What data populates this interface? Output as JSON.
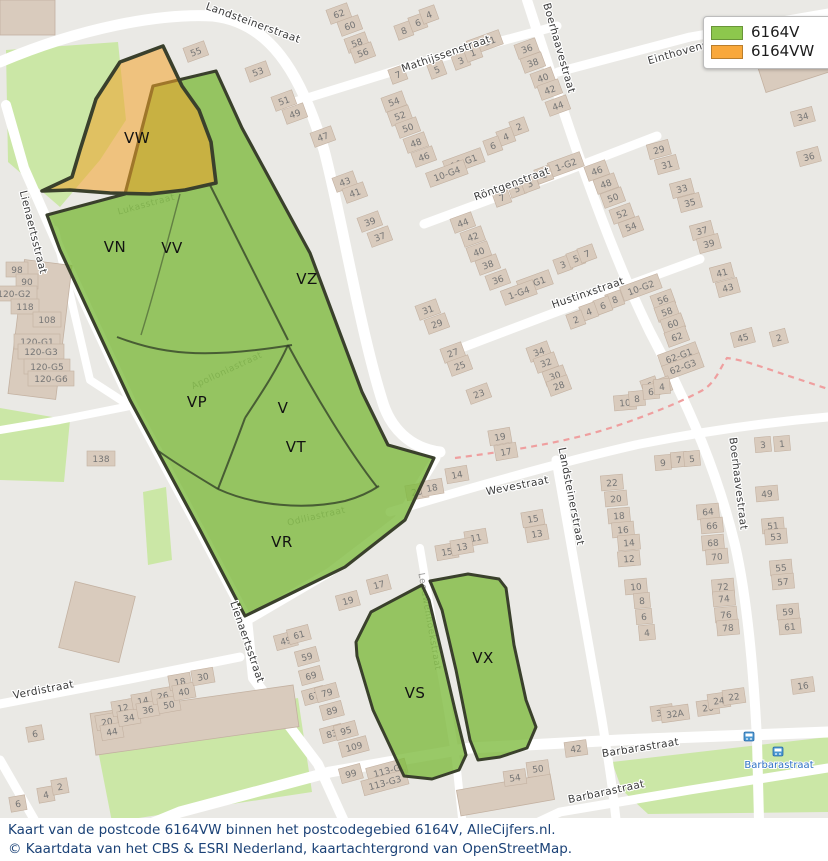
{
  "legend": {
    "items": [
      {
        "label": "6164V",
        "color": "#8dc74d"
      },
      {
        "label": "6164VW",
        "color": "#f9a83b"
      }
    ]
  },
  "caption": {
    "line1": "Kaart van de postcode 6164VW binnen het postcodegebied 6164V, AlleCijfers.nl.",
    "line2": "© Kaartdata van het CBS & ESRI Nederland, kaartachtergrond van OpenStreetMap."
  },
  "colors": {
    "area_green_fill": "rgba(124,186,60,0.78)",
    "area_orange_fill": "rgba(242,163,42,0.55)",
    "area_border": "#3a402c",
    "park": "#cbe7a6",
    "block": "#eae9e5",
    "building": "#d9cbbd",
    "boundary_dash": "#ef9f9f",
    "bus_blue": "#2f72c4"
  },
  "regions": [
    {
      "label": "VW",
      "x": 137,
      "y": 143
    },
    {
      "label": "VN",
      "x": 115,
      "y": 252
    },
    {
      "label": "VV",
      "x": 172,
      "y": 253
    },
    {
      "label": "VZ",
      "x": 307,
      "y": 284
    },
    {
      "label": "VP",
      "x": 197,
      "y": 407
    },
    {
      "label": "V",
      "x": 283,
      "y": 413
    },
    {
      "label": "VT",
      "x": 296,
      "y": 452
    },
    {
      "label": "VR",
      "x": 282,
      "y": 547
    },
    {
      "label": "VS",
      "x": 415,
      "y": 698
    },
    {
      "label": "VX",
      "x": 483,
      "y": 663
    }
  ],
  "street_labels": [
    [
      "Landsteinerstraat",
      252,
      26,
      20,
      "s"
    ],
    [
      "Mathijssenstraat",
      447,
      57,
      -19,
      "s"
    ],
    [
      "Boerhaavestraat",
      556,
      49,
      74,
      "s"
    ],
    [
      "Einthovenstraat",
      692,
      52,
      -16,
      "s"
    ],
    [
      "Röntgenstraat",
      513,
      187,
      -20,
      "s"
    ],
    [
      "Hustinxstraat",
      589,
      296,
      -19,
      "s"
    ],
    [
      "Wevestraat",
      518,
      489,
      -11,
      "s"
    ],
    [
      "Landsteinerstraat",
      568,
      497,
      79,
      "s"
    ],
    [
      "Boerhaavestraat",
      735,
      484,
      83,
      "s"
    ],
    [
      "Lienaertsstraat",
      30,
      233,
      76,
      "s"
    ],
    [
      "Lienaertsstraat",
      244,
      643,
      71,
      "s"
    ],
    [
      "Verdistraat",
      44,
      693,
      -11,
      "s"
    ],
    [
      "Barbarastraat",
      641,
      751,
      -9,
      "s"
    ],
    [
      "Barbarastraat",
      607,
      795,
      -12,
      "s"
    ],
    [
      "Apolloniastraat",
      228,
      373,
      -25,
      "f"
    ],
    [
      "Odiliastraat",
      317,
      519,
      -13,
      "f"
    ],
    [
      "Lukasstraat",
      147,
      207,
      -15,
      "f"
    ],
    [
      "Leeuwenhoekstraat",
      427,
      622,
      80,
      "f"
    ]
  ],
  "bus_stop": {
    "label": "Barbarastraat"
  },
  "building_numbers": [
    [
      "55",
      196,
      52,
      -20
    ],
    [
      "53",
      258,
      72,
      -20
    ],
    [
      "51",
      284,
      101,
      -20
    ],
    [
      "49",
      295,
      114,
      -20
    ],
    [
      "62",
      339,
      14,
      -20
    ],
    [
      "60",
      350,
      26,
      -20
    ],
    [
      "58",
      357,
      43,
      -20
    ],
    [
      "56",
      363,
      53,
      -20
    ],
    [
      "8",
      404,
      31,
      -20
    ],
    [
      "6",
      418,
      23,
      -20
    ],
    [
      "4",
      429,
      15,
      -20
    ],
    [
      "7",
      398,
      75,
      -20
    ],
    [
      "5",
      437,
      70,
      -20
    ],
    [
      "3",
      461,
      61,
      -20
    ],
    [
      "1-G1",
      485,
      43,
      -20
    ],
    [
      "1",
      473,
      53,
      -20
    ],
    [
      "54",
      394,
      102,
      -20
    ],
    [
      "52",
      400,
      116,
      -20
    ],
    [
      "50",
      408,
      128,
      -20
    ],
    [
      "48",
      416,
      143,
      -20
    ],
    [
      "47",
      323,
      137,
      -20
    ],
    [
      "36",
      527,
      49,
      -20
    ],
    [
      "38",
      533,
      63,
      -20
    ],
    [
      "40",
      543,
      78,
      -20
    ],
    [
      "42",
      550,
      90,
      -20
    ],
    [
      "44",
      558,
      106,
      -20
    ],
    [
      "2",
      519,
      127,
      -20
    ],
    [
      "4",
      506,
      137,
      -20
    ],
    [
      "6",
      493,
      146,
      -20
    ],
    [
      "46",
      424,
      157,
      -20
    ],
    [
      "10-G1",
      464,
      162,
      -20
    ],
    [
      "10-G4",
      447,
      174,
      -20
    ],
    [
      "1-G2",
      566,
      165,
      -20
    ],
    [
      "46",
      597,
      171,
      -20
    ],
    [
      "48",
      606,
      184,
      -20
    ],
    [
      "50",
      613,
      198,
      -20
    ],
    [
      "52",
      622,
      214,
      -20
    ],
    [
      "54",
      631,
      227,
      -20
    ],
    [
      "7",
      502,
      198,
      -20
    ],
    [
      "5",
      517,
      189,
      -20
    ],
    [
      "3",
      530,
      184,
      -20
    ],
    [
      "1",
      544,
      175,
      -20
    ],
    [
      "44",
      463,
      223,
      -20
    ],
    [
      "42",
      473,
      237,
      -20
    ],
    [
      "40",
      479,
      252,
      -20
    ],
    [
      "38",
      488,
      265,
      -20
    ],
    [
      "36",
      498,
      280,
      -20
    ],
    [
      "1-G1",
      535,
      283,
      -20
    ],
    [
      "1-G4",
      519,
      293,
      -20
    ],
    [
      "3",
      563,
      265,
      -20
    ],
    [
      "5",
      576,
      259,
      -20
    ],
    [
      "7",
      587,
      254,
      -20
    ],
    [
      "29",
      659,
      150,
      -15
    ],
    [
      "31",
      667,
      165,
      -15
    ],
    [
      "33",
      682,
      189,
      -15
    ],
    [
      "35",
      690,
      203,
      -15
    ],
    [
      "37",
      702,
      231,
      -15
    ],
    [
      "39",
      709,
      244,
      -15
    ],
    [
      "41",
      722,
      273,
      -15
    ],
    [
      "43",
      728,
      288,
      -15
    ],
    [
      "34",
      803,
      117,
      -15
    ],
    [
      "36",
      809,
      157,
      -15
    ],
    [
      "45",
      743,
      338,
      -15
    ],
    [
      "2",
      779,
      338,
      -15
    ],
    [
      "56",
      663,
      300,
      -20
    ],
    [
      "58",
      667,
      312,
      -20
    ],
    [
      "60",
      673,
      324,
      -20
    ],
    [
      "62",
      677,
      337,
      -20
    ],
    [
      "62-G1",
      679,
      356,
      -20
    ],
    [
      "62-G3",
      683,
      367,
      -20
    ],
    [
      "10-G2",
      641,
      288,
      -20
    ],
    [
      "8",
      615,
      300,
      -20
    ],
    [
      "6",
      603,
      306,
      -20
    ],
    [
      "4",
      589,
      312,
      -20
    ],
    [
      "2",
      576,
      320,
      -20
    ],
    [
      "34",
      539,
      352,
      -20
    ],
    [
      "32",
      546,
      363,
      -20
    ],
    [
      "30",
      555,
      376,
      -20
    ],
    [
      "28",
      559,
      386,
      -20
    ],
    [
      "27",
      453,
      353,
      -20
    ],
    [
      "25",
      460,
      366,
      -20
    ],
    [
      "23",
      479,
      394,
      -20
    ],
    [
      "31",
      428,
      310,
      -20
    ],
    [
      "29",
      437,
      324,
      -20
    ],
    [
      "6",
      650,
      386,
      -20
    ],
    [
      "4",
      663,
      386,
      -20
    ],
    [
      "43",
      345,
      182,
      -20
    ],
    [
      "41",
      355,
      193,
      -20
    ],
    [
      "39",
      370,
      222,
      -20
    ],
    [
      "37",
      380,
      237,
      -20
    ],
    [
      "10",
      625,
      403,
      -5
    ],
    [
      "8",
      637,
      399,
      -5
    ],
    [
      "6",
      651,
      392,
      -5
    ],
    [
      "4",
      662,
      387,
      -5
    ],
    [
      "9",
      663,
      463,
      -5
    ],
    [
      "7",
      679,
      460,
      -5
    ],
    [
      "5",
      692,
      459,
      -5
    ],
    [
      "22",
      612,
      483,
      -5
    ],
    [
      "20",
      616,
      499,
      -5
    ],
    [
      "18",
      619,
      516,
      -5
    ],
    [
      "16",
      623,
      530,
      -5
    ],
    [
      "14",
      629,
      543,
      -5
    ],
    [
      "12",
      629,
      559,
      -5
    ],
    [
      "64",
      708,
      512,
      -5
    ],
    [
      "66",
      712,
      526,
      -5
    ],
    [
      "68",
      713,
      543,
      -5
    ],
    [
      "70",
      717,
      557,
      -5
    ],
    [
      "10",
      636,
      587,
      -5
    ],
    [
      "8",
      642,
      601,
      -5
    ],
    [
      "6",
      644,
      617,
      -5
    ],
    [
      "4",
      647,
      633,
      -5
    ],
    [
      "72",
      723,
      587,
      -5
    ],
    [
      "74",
      724,
      599,
      -5
    ],
    [
      "76",
      726,
      615,
      -5
    ],
    [
      "78",
      728,
      628,
      -5
    ],
    [
      "3",
      763,
      445,
      -5
    ],
    [
      "1",
      782,
      444,
      -5
    ],
    [
      "49",
      767,
      494,
      -5
    ],
    [
      "51",
      773,
      526,
      -5
    ],
    [
      "53",
      776,
      537,
      -5
    ],
    [
      "55",
      781,
      568,
      -5
    ],
    [
      "57",
      783,
      582,
      -5
    ],
    [
      "59",
      788,
      612,
      -5
    ],
    [
      "61",
      790,
      627,
      -5
    ],
    [
      "19",
      500,
      437,
      -10
    ],
    [
      "17",
      506,
      452,
      -10
    ],
    [
      "14",
      457,
      475,
      -10
    ],
    [
      "20",
      417,
      492,
      -10
    ],
    [
      "18",
      432,
      488,
      -10
    ],
    [
      "15",
      533,
      519,
      -10
    ],
    [
      "13",
      537,
      534,
      -10
    ],
    [
      "11",
      476,
      538,
      -10
    ],
    [
      "15",
      447,
      552,
      -10
    ],
    [
      "13",
      462,
      547,
      -10
    ],
    [
      "17",
      379,
      585,
      -15
    ],
    [
      "19",
      348,
      601,
      -15
    ],
    [
      "49",
      286,
      641,
      -15
    ],
    [
      "61",
      299,
      635,
      -15
    ],
    [
      "59",
      307,
      657,
      -15
    ],
    [
      "69",
      311,
      676,
      -15
    ],
    [
      "67",
      314,
      696,
      -15
    ],
    [
      "79",
      327,
      693,
      -15
    ],
    [
      "89",
      332,
      711,
      -15
    ],
    [
      "83",
      332,
      734,
      -15
    ],
    [
      "95",
      346,
      731,
      -15
    ],
    [
      "109",
      354,
      747,
      -15
    ],
    [
      "99",
      351,
      774,
      -15
    ],
    [
      "113-G",
      387,
      771,
      -15
    ],
    [
      "113-G3",
      385,
      783,
      -15
    ],
    [
      "6",
      35,
      734,
      -10
    ],
    [
      "4",
      46,
      795,
      -10
    ],
    [
      "2",
      60,
      787,
      -10
    ],
    [
      "6",
      18,
      804,
      -10
    ],
    [
      "20",
      107,
      722,
      -10
    ],
    [
      "44",
      112,
      732,
      -10
    ],
    [
      "12",
      123,
      708,
      -10
    ],
    [
      "34",
      129,
      718,
      -10
    ],
    [
      "14",
      143,
      701,
      -10
    ],
    [
      "36",
      148,
      710,
      -10
    ],
    [
      "26",
      163,
      696,
      -10
    ],
    [
      "50",
      169,
      705,
      -10
    ],
    [
      "18",
      180,
      682,
      -10
    ],
    [
      "40",
      184,
      692,
      -10
    ],
    [
      "30",
      203,
      677,
      -10
    ],
    [
      "98",
      17,
      270,
      0
    ],
    [
      "90",
      27,
      282,
      0
    ],
    [
      "120-G2",
      14,
      294,
      0
    ],
    [
      "118",
      25,
      307,
      0
    ],
    [
      "108",
      47,
      320,
      0
    ],
    [
      "120-G1",
      37,
      342,
      0
    ],
    [
      "120-G3",
      41,
      352,
      0
    ],
    [
      "120-G5",
      47,
      367,
      0
    ],
    [
      "120-G6",
      51,
      379,
      0
    ],
    [
      "138",
      101,
      459,
      0
    ],
    [
      "36",
      662,
      713,
      -8
    ],
    [
      "32A",
      675,
      714,
      -8
    ],
    [
      "26",
      708,
      708,
      -8
    ],
    [
      "24",
      719,
      701,
      -8
    ],
    [
      "22",
      734,
      697,
      -8
    ],
    [
      "16",
      803,
      686,
      -8
    ],
    [
      "42",
      576,
      749,
      -8
    ],
    [
      "54",
      515,
      778,
      -8
    ],
    [
      "50",
      538,
      769,
      -8
    ]
  ]
}
